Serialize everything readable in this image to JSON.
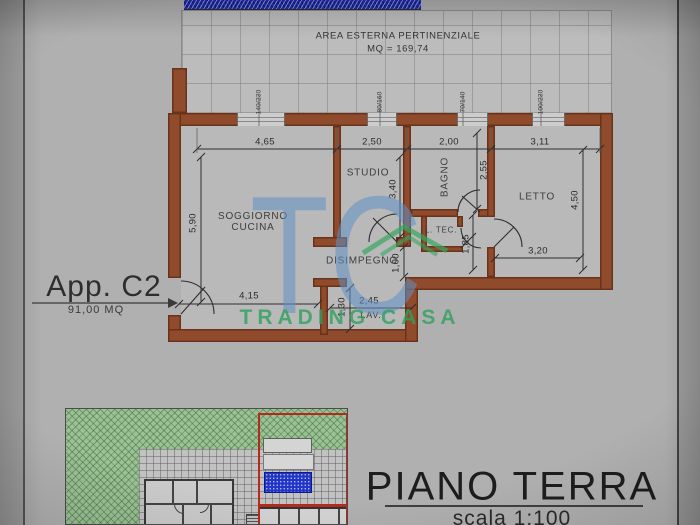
{
  "external_area": {
    "title": "AREA ESTERNA PERTINENZIALE",
    "area": "MQ = 169,74"
  },
  "apartment": {
    "name": "App. C2",
    "area": "91,00 MQ"
  },
  "rooms": {
    "soggiorno1": "SOGGIORNO",
    "soggiorno2": "CUCINA",
    "studio": "STUDIO",
    "bagno": "BAGNO",
    "letto": "LETTO",
    "disimpegno": "DISIMPEGNO",
    "ltec": "L. TEC.",
    "lav": "LAV."
  },
  "dims": {
    "w465": "4,65",
    "w250": "2,50",
    "w200": "2,00",
    "w311": "3,11",
    "w415": "4,15",
    "w245": "2,45",
    "w320": "3,20",
    "h590": "5,90",
    "h340": "3,40",
    "h255": "2,55",
    "h450": "4,50",
    "h185": "1,85",
    "h100": "1,00",
    "h130": "1,30"
  },
  "windows": [
    "140/230",
    "80/160",
    "70/140",
    "100/230"
  ],
  "watermark": {
    "tc": "TC",
    "name": "TRADING CASA"
  },
  "titleblock": {
    "title": "PIANO TERRA",
    "scale": "scala 1:100"
  },
  "colors": {
    "wall": "#8f4b2b",
    "hatch_blue": "#1e2db8",
    "site_green": "#9fbf97",
    "highlight_blue": "#2135c8",
    "boundary_red": "#b52a1c",
    "watermark_blue": "#6092c7",
    "watermark_green": "#34a860"
  }
}
